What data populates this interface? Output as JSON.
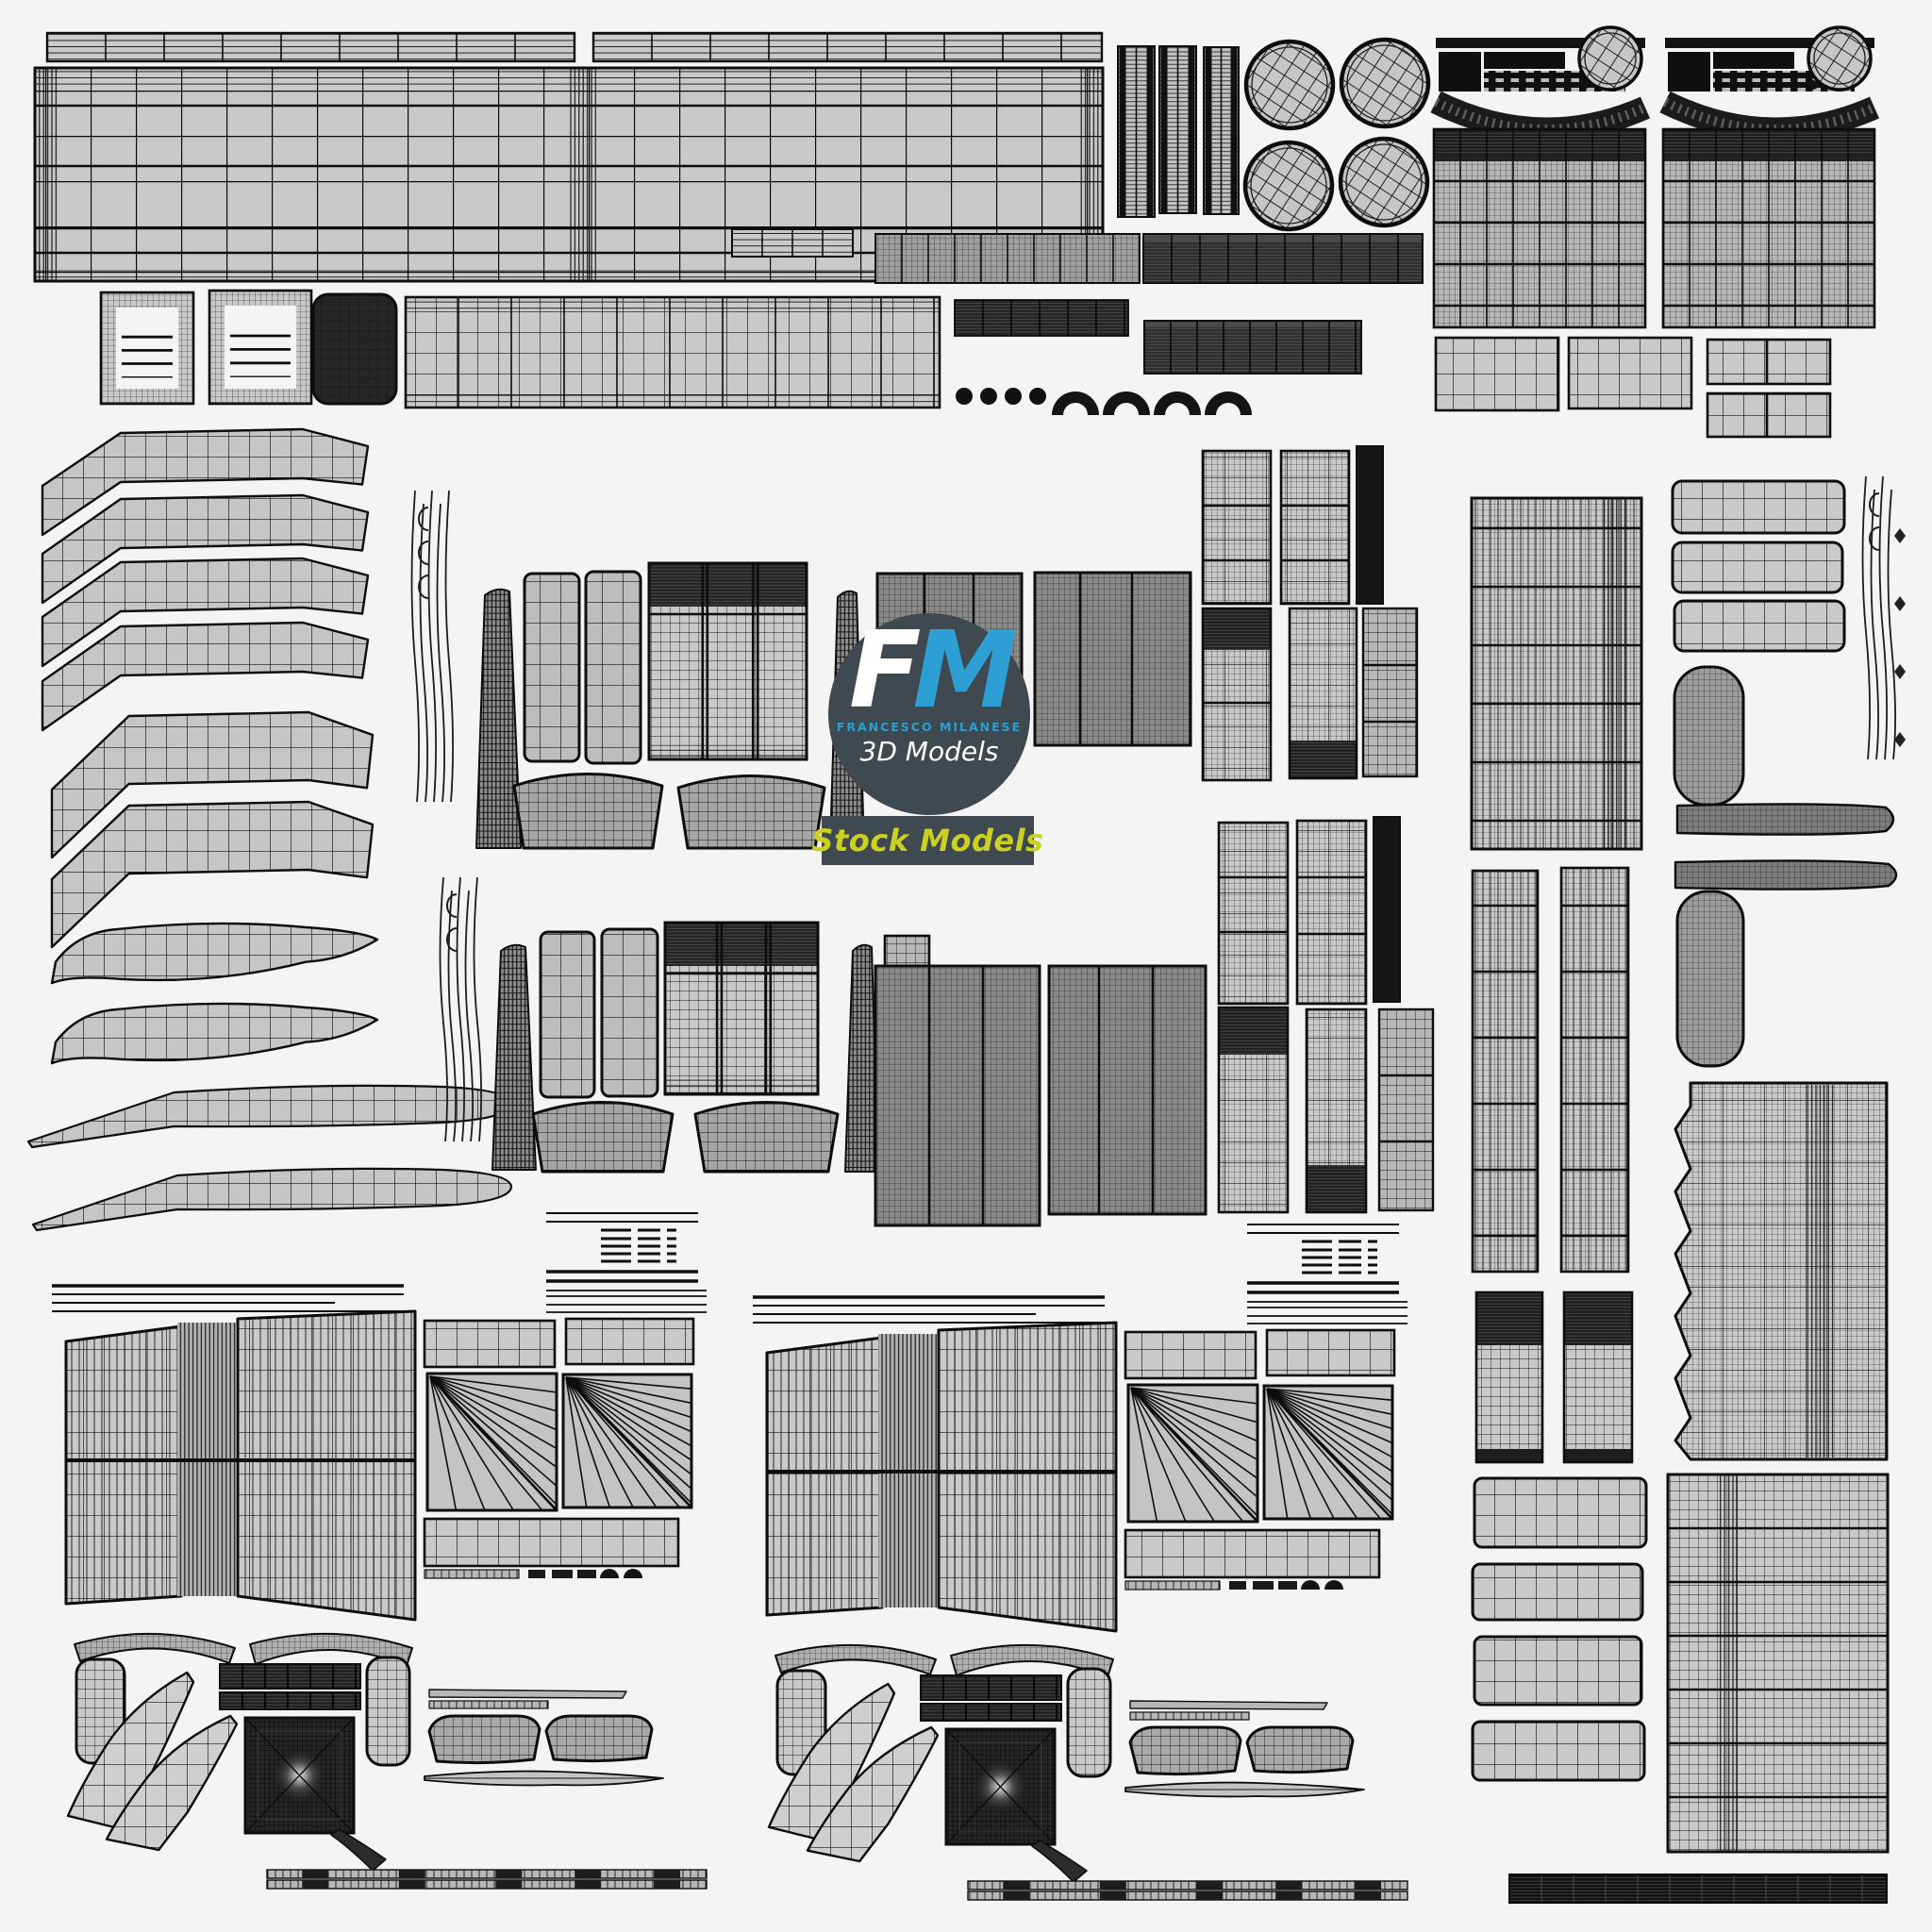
{
  "watermark": {
    "initial_f": "F",
    "initial_m": "M",
    "subtitle": "FRANCESCO MILANESE",
    "tagline": "3D Models",
    "badge_label": "Stock Models"
  },
  "palette": {
    "background": "#f4f4f4",
    "watermark_circle": "#3e4a50",
    "watermark_blue": "#2e9fd4",
    "watermark_white": "#ffffff",
    "badge_yellow": "#ccd11f",
    "wireframe_light": "#c9c9c9",
    "wireframe_medium": "#b7b7b7",
    "wireframe_dark": "#2a2a2a",
    "wireframe_line": "#0d0d0d"
  }
}
